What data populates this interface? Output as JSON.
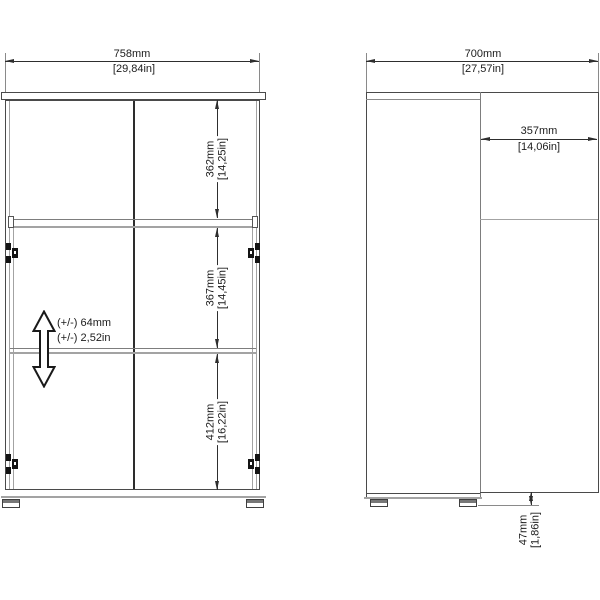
{
  "front_view": {
    "width": {
      "mm": "758mm",
      "inches": "[29,84in]"
    },
    "sections": [
      {
        "mm": "362mm",
        "inches": "[14,25in]"
      },
      {
        "mm": "367mm",
        "inches": "[14,45in]"
      },
      {
        "mm": "412mm",
        "inches": "[16,22in]"
      }
    ],
    "shelf_adjust": {
      "mm": "(+/-) 64mm",
      "inches": "(+/-) 2,52in"
    }
  },
  "side_view": {
    "total_depth": {
      "mm": "700mm",
      "inches": "[27,57in]"
    },
    "body_depth": {
      "mm": "357mm",
      "inches": "[14,06in]"
    },
    "foot_height": {
      "mm": "47mm",
      "inches": "[1,86in]"
    }
  },
  "colors": {
    "outline": "#4a4a4a",
    "dimension": "#2e2e2e",
    "light_line": "#a3a3a3"
  }
}
